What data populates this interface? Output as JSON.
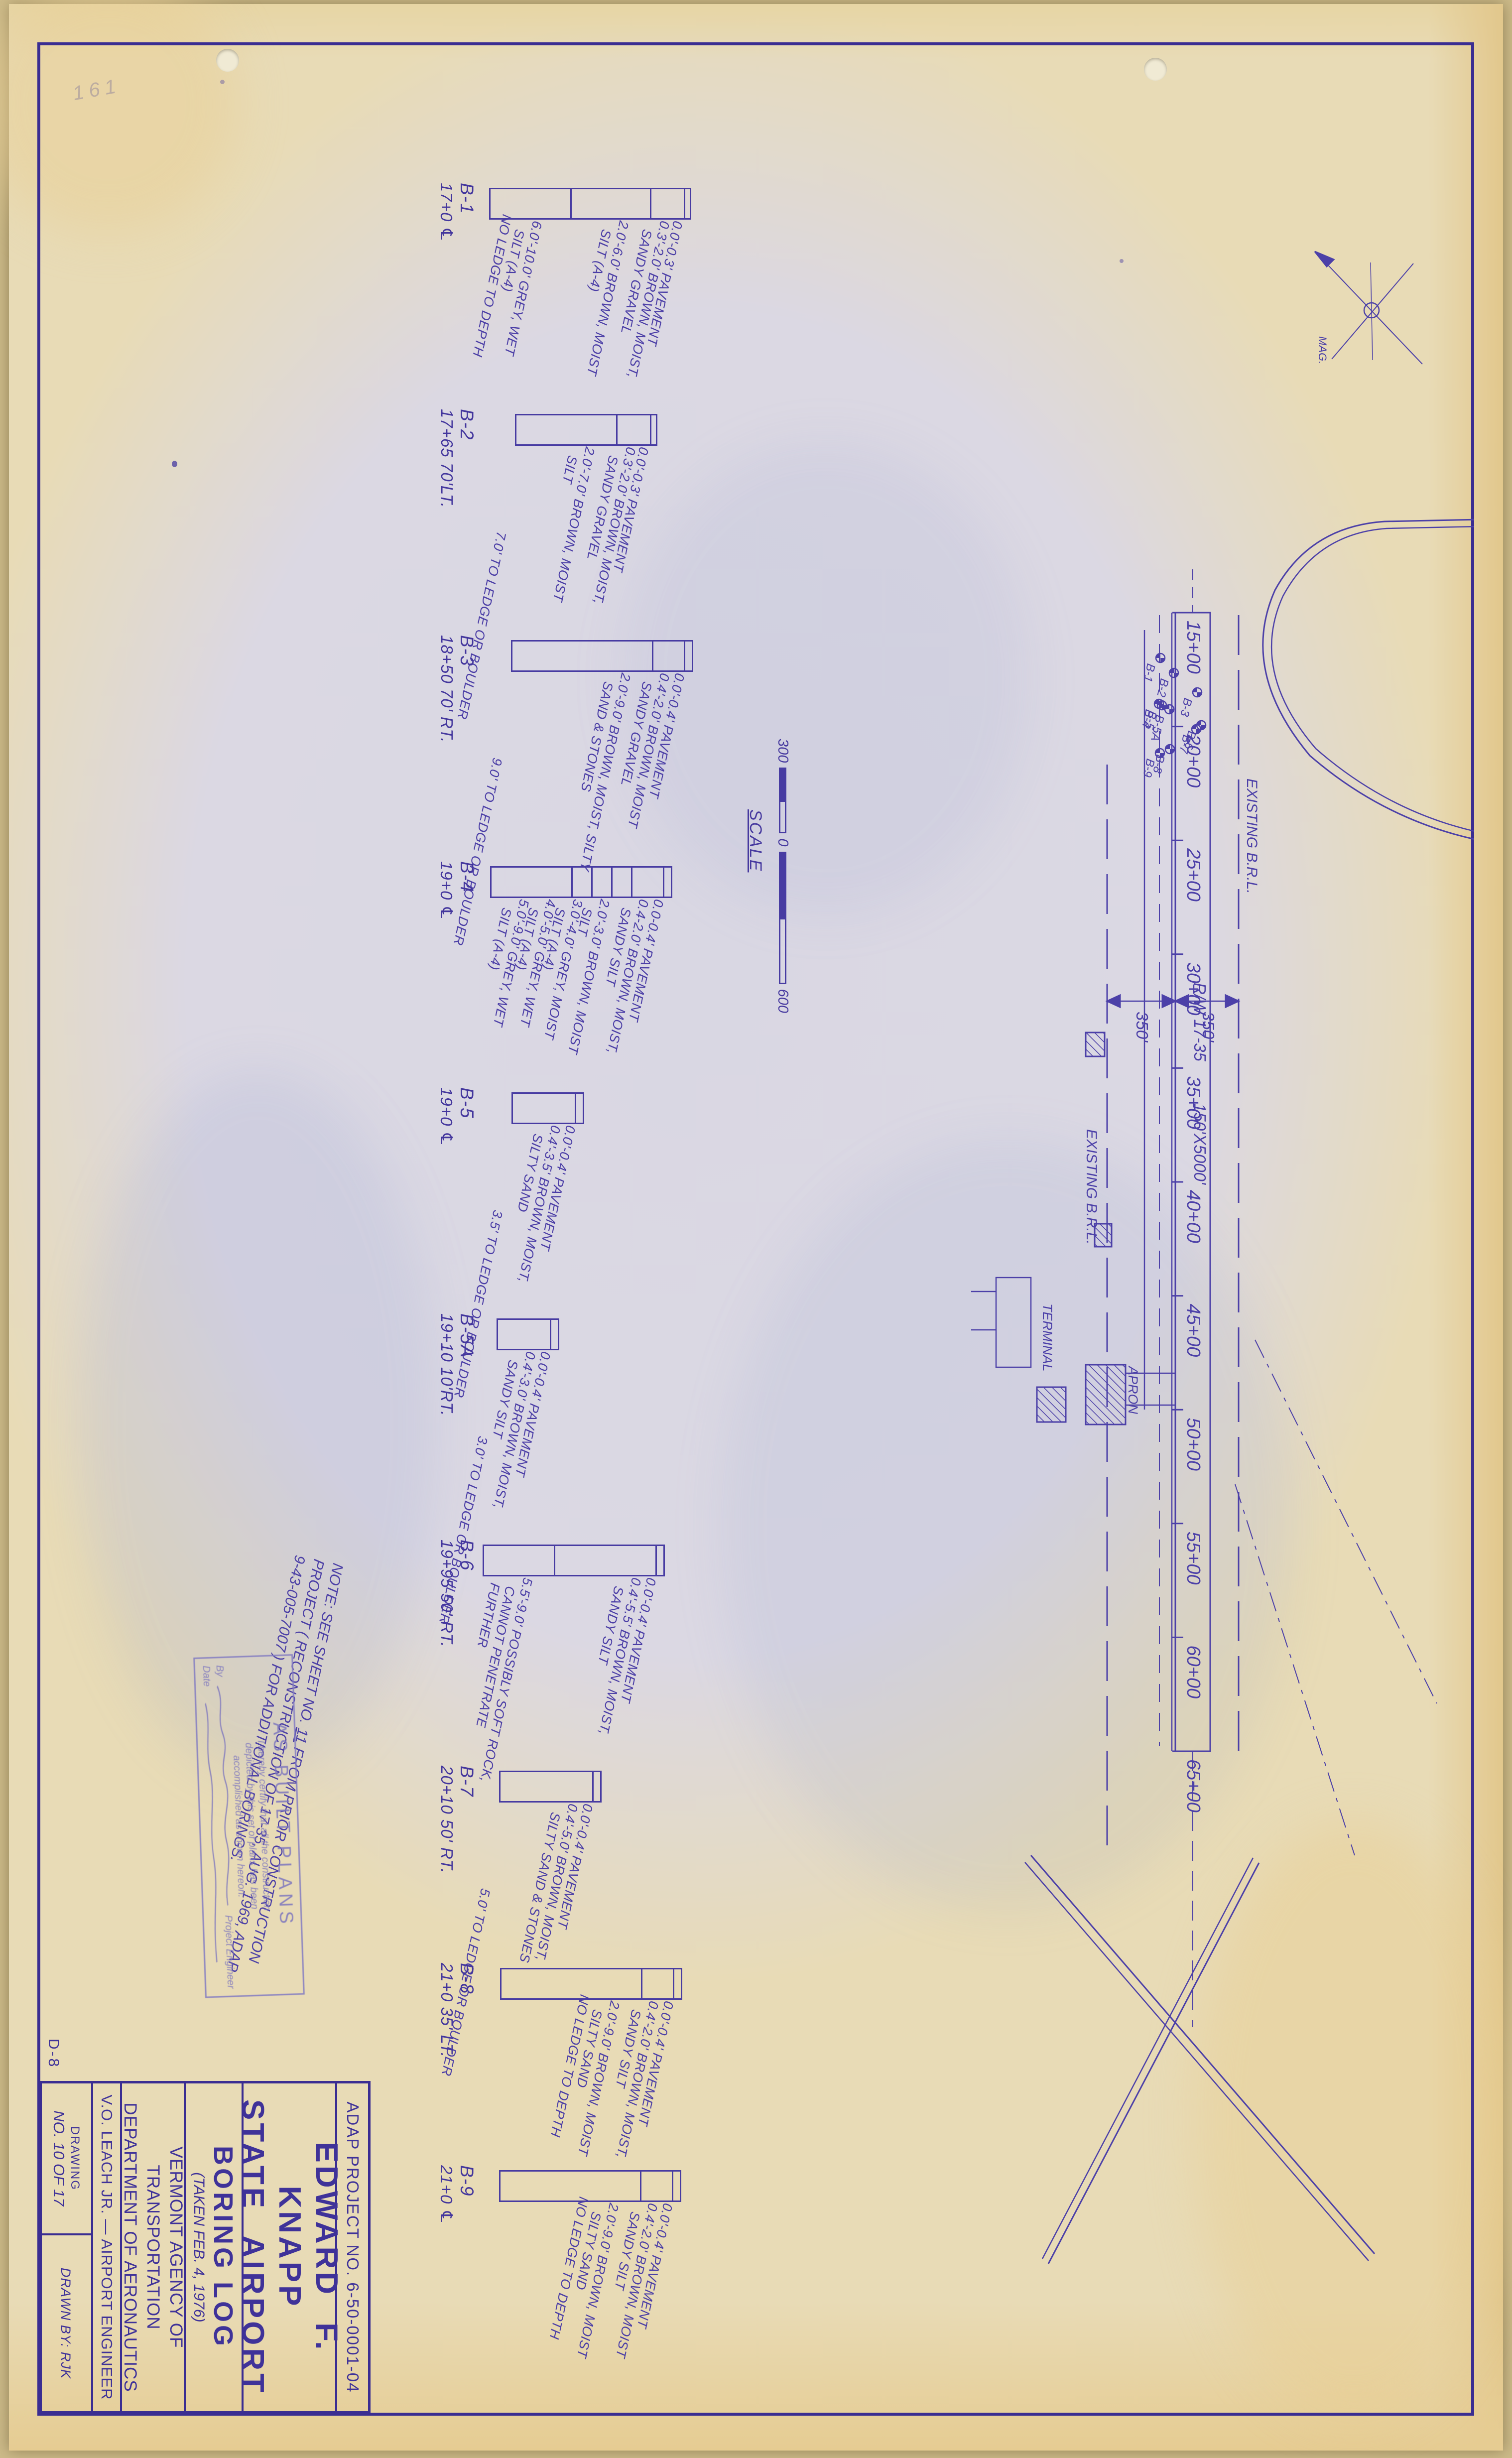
{
  "sheet_meta": {
    "margin_note": "161",
    "corner_mark": "D-8"
  },
  "title_block": {
    "project_no": "ADAP PROJECT NO. 6-50-0001-04",
    "airport_line1": "EDWARD F. KNAPP",
    "airport_line2": "STATE AIRPORT",
    "title": "BORING LOG",
    "subtitle": "(TAKEN FEB. 4, 1976)",
    "agency_line1": "VERMONT AGENCY OF TRANSPORTATION",
    "agency_line2": "DEPARTMENT OF AERONAUTICS",
    "engineer": "V.O. LEACH JR. — AIRPORT ENGINEER",
    "drawing_word": "DRAWING",
    "drawing_no": "NO. 10 OF 17",
    "drawn_by": "DRAWN BY: RJK"
  },
  "note": {
    "prefix": "NOTE: SEE SHEET NO. ",
    "sheet_no": "11",
    "line1_suffix": " FROM PRIOR CONSTRUCTION",
    "line2": "PROJECT ( RECONSTRUCTION OF 17-35, AUG. 1969, ADAP",
    "line3": "9-43-005-7007 ) FOR ADDITIONAL BORINGS."
  },
  "stamp": {
    "title": "AS BUILT PLANS",
    "line1": "I hereby certify that all the construction",
    "line2": "depicted by this set of plans has been",
    "line3": "accomplished as shown hereon.",
    "by_label": "By",
    "engineer_label": "Project Engineer",
    "date_label": "Date"
  },
  "scale_bar": {
    "label": "SCALE",
    "left_value": "300",
    "zero_value": "0",
    "right_value": "600"
  },
  "map": {
    "stations": [
      "15+00",
      "20+00",
      "25+00",
      "30+00",
      "35+00",
      "40+00",
      "45+00",
      "50+00",
      "55+00",
      "60+00",
      "65+00"
    ],
    "existing_brl_top": "EXISTING B.R.L.",
    "existing_brl_bottom": "EXISTING B.R.L.",
    "dim_top": "350'",
    "dim_bottom": "350'",
    "runway_label": "R/W 17-35",
    "runway_size": "150'X5000'",
    "terminal": "TERMINAL",
    "apron": "APRON",
    "north_label": "MAG.",
    "markers": [
      "B-1",
      "B-2",
      "B-3",
      "B-4",
      "B-5",
      "B-5A",
      "B-6",
      "B-7",
      "B-8",
      "B-9"
    ]
  },
  "borings": [
    {
      "name": "B-1",
      "station": "17+0 ℄",
      "depth_ft": 10.0,
      "segments": [
        {
          "from": 0.0,
          "to": 0.3,
          "desc": "0.0'-0.3' PAVEMENT"
        },
        {
          "from": 0.3,
          "to": 2.0,
          "desc": "0.3'-2.0' BROWN, MOIST,\n   SANDY GRAVEL"
        },
        {
          "from": 2.0,
          "to": 6.0,
          "desc": "2.0'-6.0' BROWN, MOIST\n   SILT (A-4)"
        },
        {
          "from": 6.0,
          "to": 10.0,
          "desc": "6.0'-10.0' GREY, WET\n   SILT (A-4)\nNO LEDGE TO DEPTH"
        }
      ],
      "end_note": ""
    },
    {
      "name": "B-2",
      "station": "17+65 70'LT.",
      "depth_ft": 7.0,
      "segments": [
        {
          "from": 0.0,
          "to": 0.3,
          "desc": "0.0'-0.3' PAVEMENT"
        },
        {
          "from": 0.3,
          "to": 2.0,
          "desc": "0.3'-2.0' BROWN, MOIST,\n   SANDY GRAVEL"
        },
        {
          "from": 2.0,
          "to": 7.0,
          "desc": "2.0'-7.0' BROWN, MOIST\n   SILT"
        }
      ],
      "end_note": "7.0' TO LEDGE OR BOULDER"
    },
    {
      "name": "B-3",
      "station": "18+50 70' RT.",
      "depth_ft": 9.0,
      "segments": [
        {
          "from": 0.0,
          "to": 0.4,
          "desc": "0.0'-0.4' PAVEMENT"
        },
        {
          "from": 0.4,
          "to": 2.0,
          "desc": "0.4'-2.0' BROWN, MOIST\n   SANDY GRAVEL"
        },
        {
          "from": 2.0,
          "to": 9.0,
          "desc": "2.0'-9.0' BROWN, MOIST, SILTY\n   SAND & STONES"
        }
      ],
      "end_note": "9.0' TO LEDGE OR BOULDER"
    },
    {
      "name": "B-4",
      "station": "19+0 ℄",
      "depth_ft": 9.0,
      "segments": [
        {
          "from": 0.0,
          "to": 0.4,
          "desc": "0.0-0.4' PAVEMENT"
        },
        {
          "from": 0.4,
          "to": 2.0,
          "desc": "0.4-2.0' BROWN, MOIST,\n   SANDY SILT"
        },
        {
          "from": 2.0,
          "to": 3.0,
          "desc": "2.0'-3.0' BROWN, MOIST\n   SILT"
        },
        {
          "from": 3.0,
          "to": 4.0,
          "desc": "3.0'-4.0' GREY, MOIST\n   SILT (A-4)"
        },
        {
          "from": 4.0,
          "to": 5.0,
          "desc": "4.0'-5.0' GREY, WET\n   SILT (A-4)"
        },
        {
          "from": 5.0,
          "to": 9.0,
          "desc": "5.0'-9.0' GREY, WET\n   SILT (A-4)"
        }
      ],
      "end_note": ""
    },
    {
      "name": "B-5",
      "station": "19+0 ℄",
      "depth_ft": 3.5,
      "segments": [
        {
          "from": 0.0,
          "to": 0.4,
          "desc": "0.0'-0.4' PAVEMENT"
        },
        {
          "from": 0.4,
          "to": 3.5,
          "desc": "0.4'-3.5' BROWN, MOIST,\n   SILTY SAND"
        }
      ],
      "end_note": "3.5' TO LEDGE OR BOULDER"
    },
    {
      "name": "B-5A",
      "station": "19+10 10'RT.",
      "depth_ft": 3.0,
      "segments": [
        {
          "from": 0.0,
          "to": 0.4,
          "desc": "0.0'-0.4' PAVEMENT"
        },
        {
          "from": 0.4,
          "to": 3.0,
          "desc": "0.4'-3.0' BROWN, MOIST,\n   SANDY SILT"
        }
      ],
      "end_note": "3.0' TO LEDGE OR BOULDER"
    },
    {
      "name": "B-6",
      "station": "19+95 50' RT.",
      "depth_ft": 9.0,
      "segments": [
        {
          "from": 0.0,
          "to": 0.4,
          "desc": "0.0'-0.4' PAVEMENT"
        },
        {
          "from": 0.4,
          "to": 5.5,
          "desc": "0.4'-5.5' BROWN, MOIST,\n   SANDY SILT"
        },
        {
          "from": 5.5,
          "to": 9.0,
          "desc": "5.5'-9.0' POSSIBLY SOFT ROCK,\n   CANNOT PENETRATE\n   FURTHER"
        }
      ],
      "end_note": ""
    },
    {
      "name": "B-7",
      "station": "20+10 50' RT.",
      "depth_ft": 5.0,
      "segments": [
        {
          "from": 0.0,
          "to": 0.4,
          "desc": "0.0'-0.4' PAVEMENT"
        },
        {
          "from": 0.4,
          "to": 5.0,
          "desc": "0.4'-5.0' BROWN, MOIST,\n   SILTY SAND & STONES"
        }
      ],
      "end_note": "5.0' TO LEDGE OR BOULDER"
    },
    {
      "name": "B-8",
      "station": "21+0 35' LT.",
      "depth_ft": 9.0,
      "segments": [
        {
          "from": 0.0,
          "to": 0.4,
          "desc": "0.0'-0.4' PAVEMENT"
        },
        {
          "from": 0.4,
          "to": 2.0,
          "desc": "0.4'-2.0' BROWN, MOIST,\n   SANDY SILT"
        },
        {
          "from": 2.0,
          "to": 9.0,
          "desc": "2.0'-9.0' BROWN, MOIST\n   SILTY SAND\nNO LEDGE TO DEPTH"
        }
      ],
      "end_note": ""
    },
    {
      "name": "B-9",
      "station": "21+0 ℄",
      "depth_ft": 9.0,
      "segments": [
        {
          "from": 0.0,
          "to": 0.4,
          "desc": "0.0'-0.4' PAVEMENT"
        },
        {
          "from": 0.4,
          "to": 2.0,
          "desc": "0.4'-2.0' BROWN, MOIST\n   SANDY SILT"
        },
        {
          "from": 2.0,
          "to": 9.0,
          "desc": "2.0'-9.0' BROWN, MOIST\n   SILTY SAND\nNO LEDGE TO DEPTH"
        }
      ],
      "end_note": ""
    }
  ]
}
